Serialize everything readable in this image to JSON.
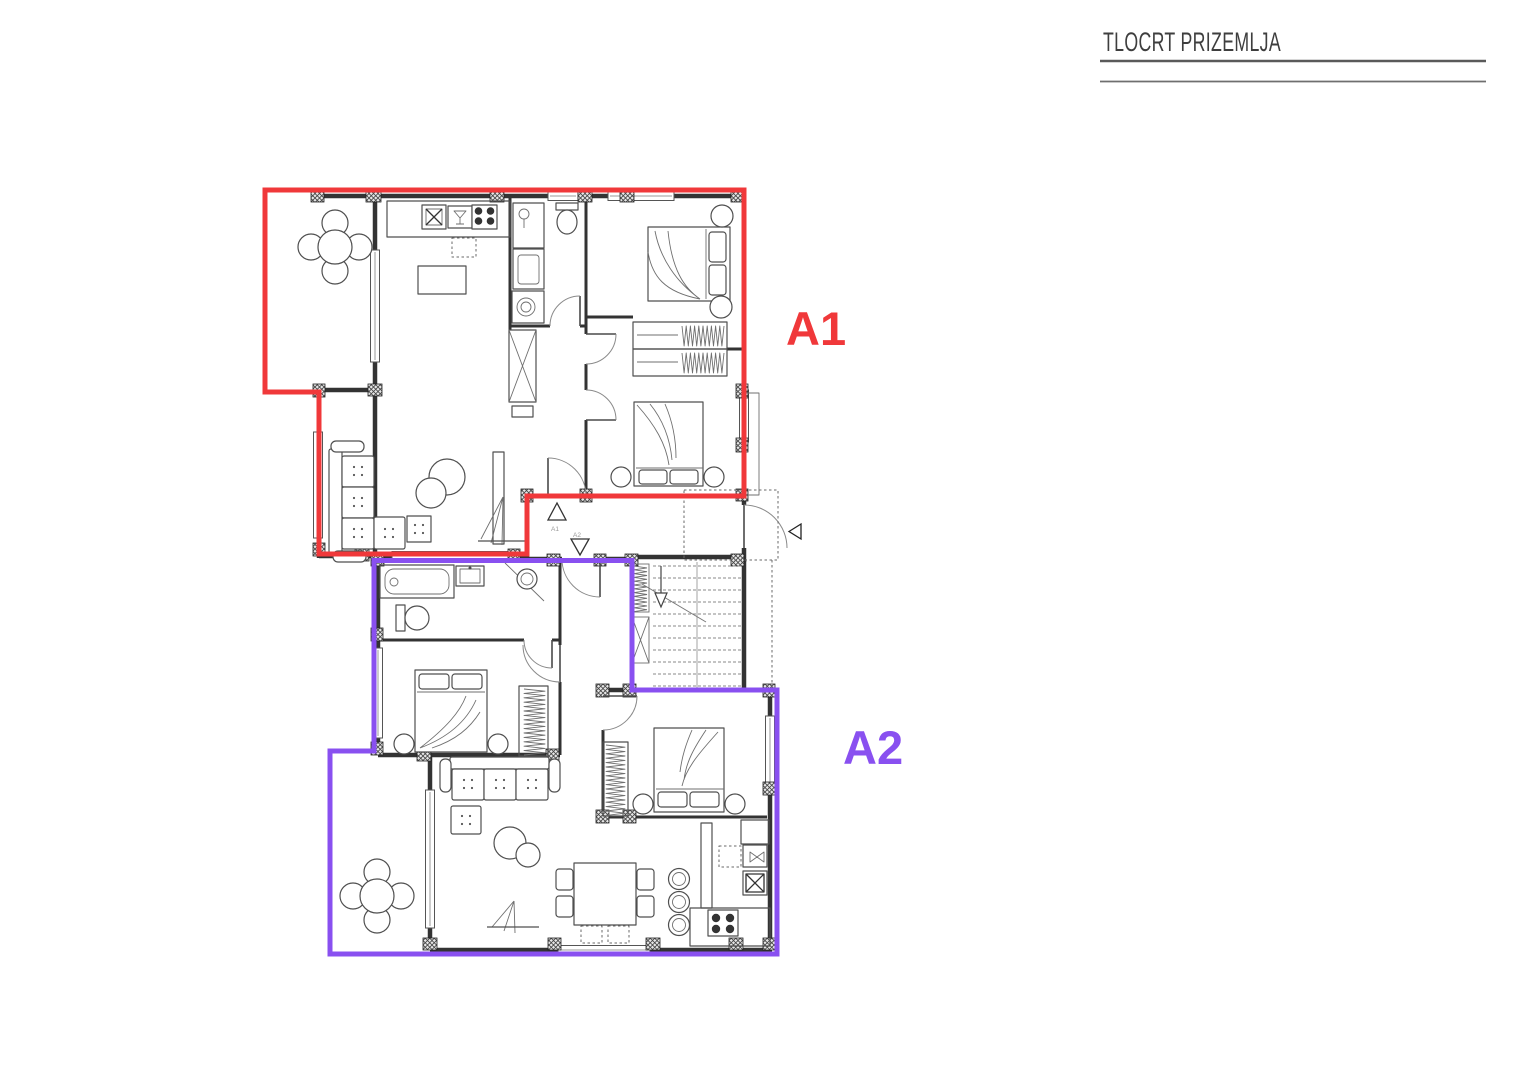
{
  "title": {
    "text": "TLOCRT PRIZEMLJA"
  },
  "apartments": [
    {
      "id": "A1",
      "label": "A1",
      "color": "#f0383a",
      "entry_label": "A1"
    },
    {
      "id": "A2",
      "label": "A2",
      "color": "#8950f0",
      "entry_label": "A2"
    }
  ],
  "colors": {
    "walls": "#333333",
    "furniture": "#4f4f4f",
    "title_text": "#3e3e3e"
  }
}
